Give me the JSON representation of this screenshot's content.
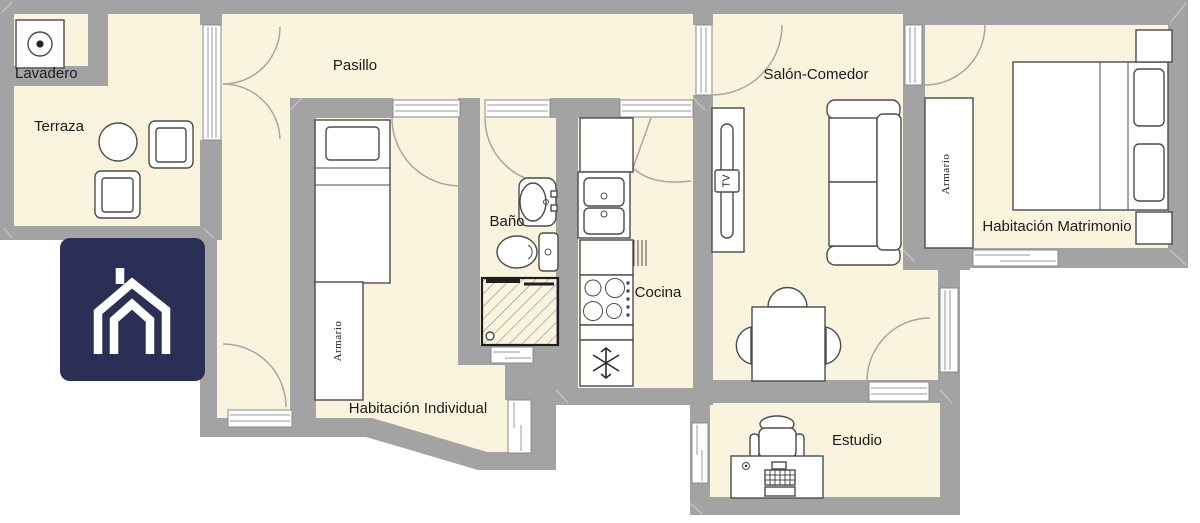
{
  "palette": {
    "wall": "#a3a3a3",
    "floor": "#faf3dd",
    "furniture_outline": "#4b4b4b",
    "door_arc": "#a6a6a6",
    "logo_bg": "#2b2f55",
    "logo_glyph": "#ffffff",
    "label_text": "#1b1b1b"
  },
  "rooms": {
    "lavadero": {
      "label": "Lavadero"
    },
    "terraza": {
      "label": "Terraza"
    },
    "pasillo": {
      "label": "Pasillo"
    },
    "bano": {
      "label": "Baño"
    },
    "cocina": {
      "label": "Cocina"
    },
    "salon_comedor": {
      "label": "Salón-Comedor"
    },
    "habitacion_matrimonio": {
      "label": "Habitación Matrimonio"
    },
    "habitacion_individual": {
      "label": "Habitación Individual"
    },
    "estudio": {
      "label": "Estudio"
    }
  },
  "furniture": {
    "wardrobe_label": "Armario",
    "tv_label": "TV"
  },
  "icons": {
    "washing_machine": "washing-machine-icon",
    "round_table": "round-table-icon",
    "chairs": "chair-icon",
    "single_bed": "single-bed-icon",
    "double_bed": "double-bed-icon",
    "wardrobe": "wardrobe-icon",
    "washbasin": "washbasin-icon",
    "toilet": "toilet-icon",
    "shower": "shower-icon",
    "kitchen_sink": "kitchen-sink-icon",
    "stove": "stove-icon",
    "fridge_snowflake": "snowflake-icon",
    "radiator": "radiator-icon",
    "tv_unit": "tv-unit-icon",
    "sofa": "sofa-icon",
    "dining_table": "dining-table-icon",
    "desk": "desk-icon",
    "office_chair": "office-chair-icon",
    "house_logo": "house-logo-icon"
  }
}
